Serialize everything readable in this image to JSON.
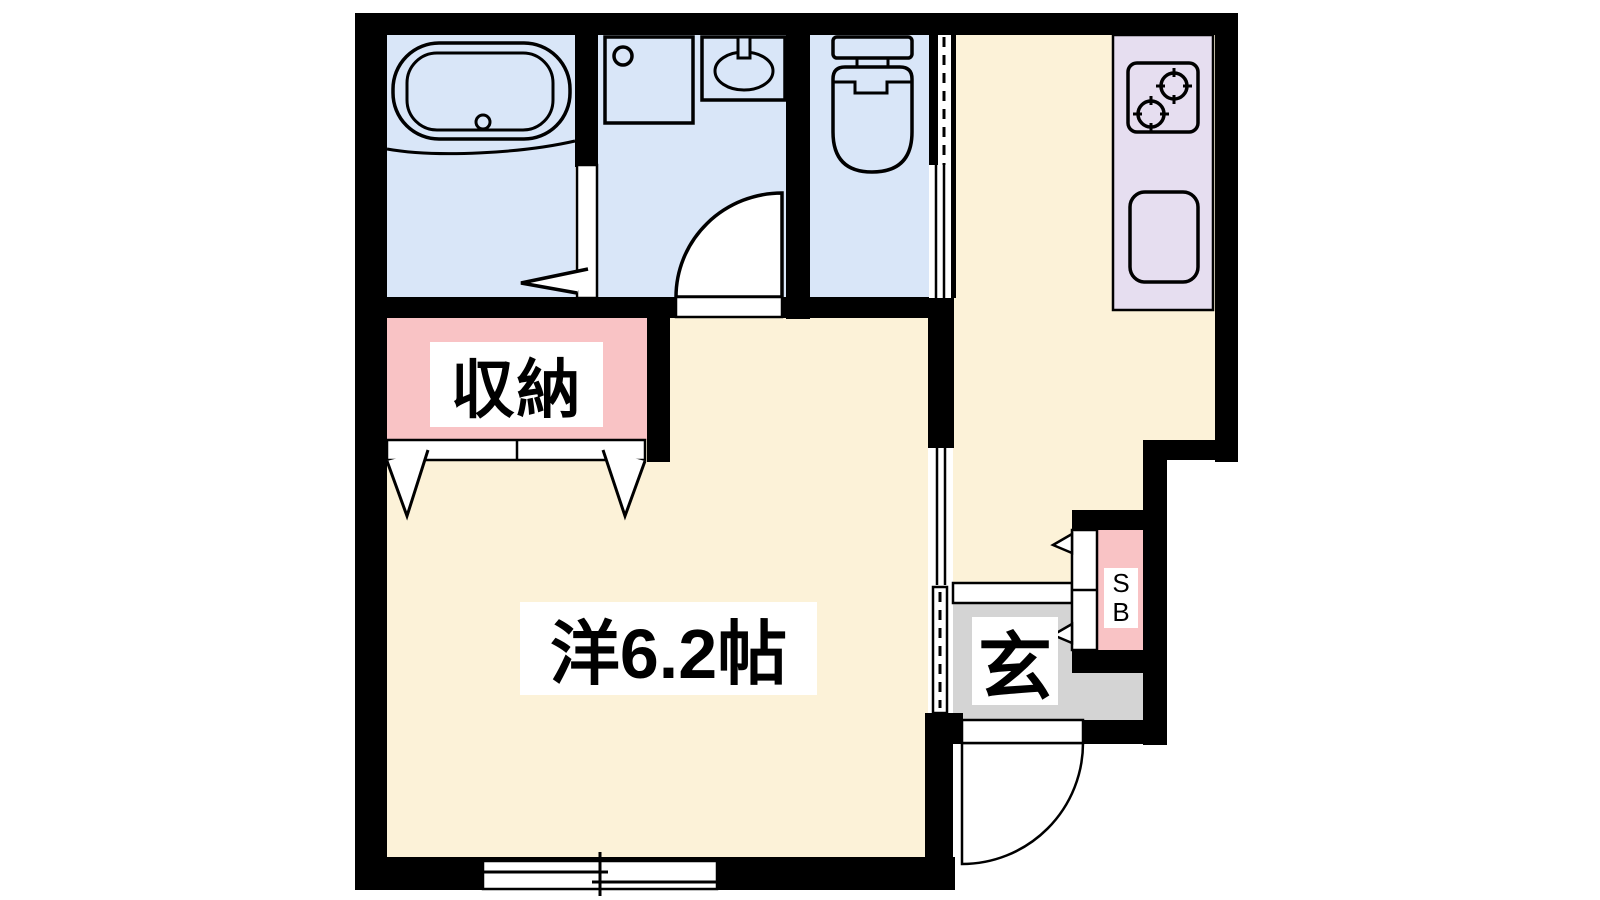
{
  "plan": {
    "type": "apartment-floor-plan",
    "labels": {
      "closet": "収納",
      "main_room": "洋6.2帖",
      "entrance": "玄",
      "shoe_box_line1": "S",
      "shoe_box_line2": "B"
    },
    "rooms": [
      {
        "name": "bathroom",
        "color_key": "wet_area"
      },
      {
        "name": "washroom",
        "color_key": "wet_area"
      },
      {
        "name": "toilet",
        "color_key": "wet_area"
      },
      {
        "name": "kitchen-hall",
        "color_key": "living_area"
      },
      {
        "name": "main-room",
        "label": "洋6.2帖",
        "color_key": "living_area"
      },
      {
        "name": "closet",
        "label": "収納",
        "color_key": "closet_pink"
      },
      {
        "name": "entrance",
        "label": "玄",
        "color_key": "entrance_gray"
      },
      {
        "name": "shoe-box",
        "label": "SB",
        "color_key": "closet_pink"
      }
    ],
    "fixture_icons": [
      "bathtub-icon",
      "washing-machine-pan-icon",
      "lavatory-sink-icon",
      "toilet-icon",
      "two-burner-stove-icon",
      "kitchen-sink-icon",
      "sliding-window-icon",
      "entrance-door-swing-icon",
      "closet-folding-doors-icon",
      "shoe-box-folding-doors-icon"
    ]
  },
  "colors": {
    "wall": "#000000",
    "wet_area": "#d9e6f8",
    "living_area": "#fcf2d8",
    "kitchen_counter": "#e6def0",
    "closet_pink": "#f9c3c5",
    "entrance_gray": "#d4d4d4",
    "opening_white": "#ffffff",
    "label_bg": "#ffffff",
    "line": "#000000"
  }
}
